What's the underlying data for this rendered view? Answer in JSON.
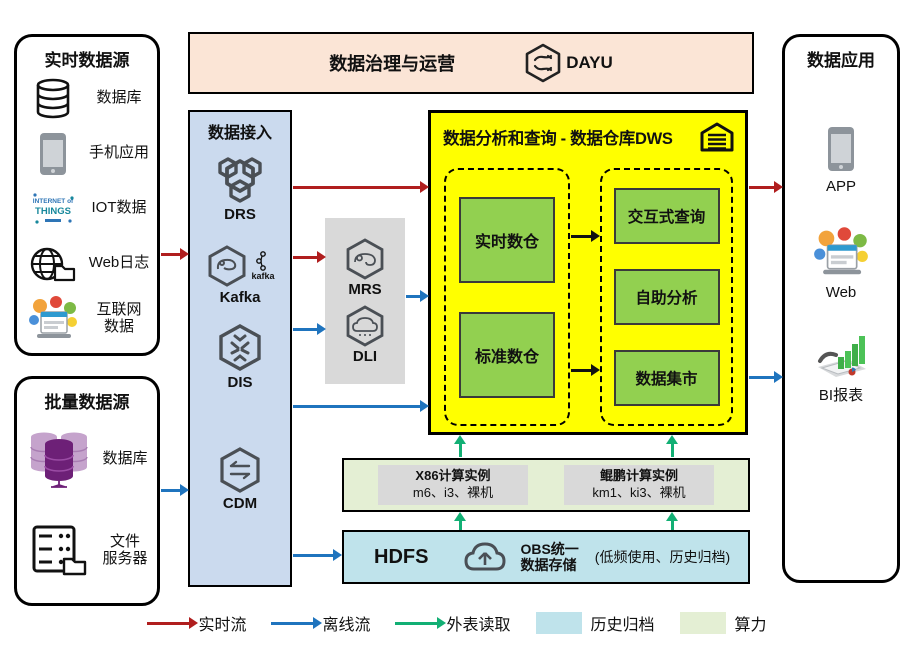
{
  "palette": {
    "realtime": "#B01E1E",
    "offline": "#1F74BE",
    "external": "#12AF74",
    "history": "#BFE3EB",
    "compute": "#E4EFD4",
    "warehouse": "#FFFF00",
    "unit": "#92D050",
    "ingestion": "#CBDAEE",
    "banner": "#FBE5D6",
    "gray": "#D9D9D9"
  },
  "governance": {
    "title": "数据治理与运营",
    "product": "DAYU"
  },
  "realtime_sources": {
    "title": "实时数据源",
    "items": [
      {
        "label1": "数据库",
        "label2": ""
      },
      {
        "label1": "手机应用",
        "label2": ""
      },
      {
        "label1": "IOT数据",
        "label2": ""
      },
      {
        "label1": "Web日志",
        "label2": ""
      },
      {
        "label1": "互联网",
        "label2": "数据"
      }
    ],
    "iot_icon_words": {
      "line1": "INTERNET of",
      "line2": "THINGS"
    }
  },
  "batch_sources": {
    "title": "批量数据源",
    "items": [
      {
        "label1": "数据库",
        "label2": ""
      },
      {
        "label1": "文件",
        "label2": "服务器"
      }
    ]
  },
  "ingestion": {
    "title": "数据接入",
    "services": [
      {
        "label": "DRS"
      },
      {
        "label": "Kafka",
        "badge": "kafka"
      },
      {
        "label": "DIS"
      },
      {
        "label": "CDM"
      }
    ]
  },
  "processing": {
    "services": [
      {
        "label": "MRS"
      },
      {
        "label": "DLI"
      }
    ]
  },
  "dws": {
    "title": "数据分析和查询 - 数据仓库DWS",
    "warehouses": [
      {
        "label": "实时数仓"
      },
      {
        "label": "标准数仓"
      }
    ],
    "marts": [
      {
        "label": "交互式查询"
      },
      {
        "label": "自助分析"
      },
      {
        "label": "数据集市"
      }
    ]
  },
  "compute_bar": {
    "instances": [
      {
        "title": "X86计算实例",
        "spec": "m6、i3、裸机"
      },
      {
        "title": "鲲鹏计算实例",
        "spec": "km1、ki3、裸机"
      }
    ]
  },
  "storage_bar": {
    "hdfs": "HDFS",
    "obs_line1": "OBS统一",
    "obs_line2": "数据存储",
    "note": "(低频使用、历史归档)"
  },
  "applications": {
    "title": "数据应用",
    "items": [
      {
        "label": "APP"
      },
      {
        "label": "Web"
      },
      {
        "label": "BI报表"
      }
    ]
  },
  "legend": {
    "items": [
      {
        "label": "实时流"
      },
      {
        "label": "离线流"
      },
      {
        "label": "外表读取"
      },
      {
        "label": "历史归档"
      },
      {
        "label": "算力"
      }
    ]
  }
}
